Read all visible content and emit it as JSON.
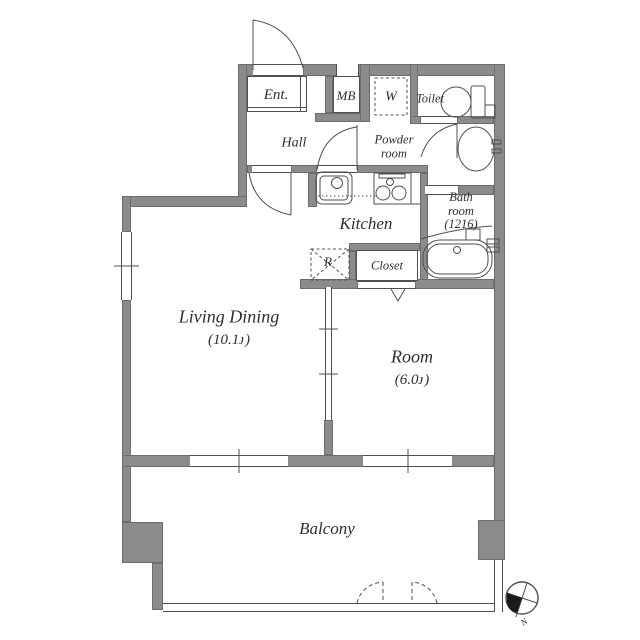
{
  "plan": {
    "rooms": {
      "living_dining": {
        "name": "Living Dining",
        "area": "(10.1ᴊ)"
      },
      "room": {
        "name": "Room",
        "area": "(6.0ᴊ)"
      },
      "balcony": {
        "name": "Balcony"
      },
      "kitchen": {
        "name": "Kitchen"
      },
      "hall": {
        "name": "Hall"
      },
      "entrance": {
        "name": "Ent."
      },
      "meter_box": {
        "name": "MB"
      },
      "washing_machine": {
        "name": "W"
      },
      "toilet": {
        "name": "Toilet"
      },
      "powder_room": {
        "line1": "Powder",
        "line2": "room"
      },
      "bath_room": {
        "line1": "Bath",
        "line2": "room",
        "line3": "(1216)"
      },
      "closet": {
        "name": "Closet"
      },
      "refrigerator": {
        "name": "R"
      }
    },
    "compass": {
      "north": "N"
    },
    "colors": {
      "wall": "#8b8b8b",
      "line": "#4f4f4f",
      "text": "#2e2e2e",
      "background": "#ffffff"
    }
  }
}
